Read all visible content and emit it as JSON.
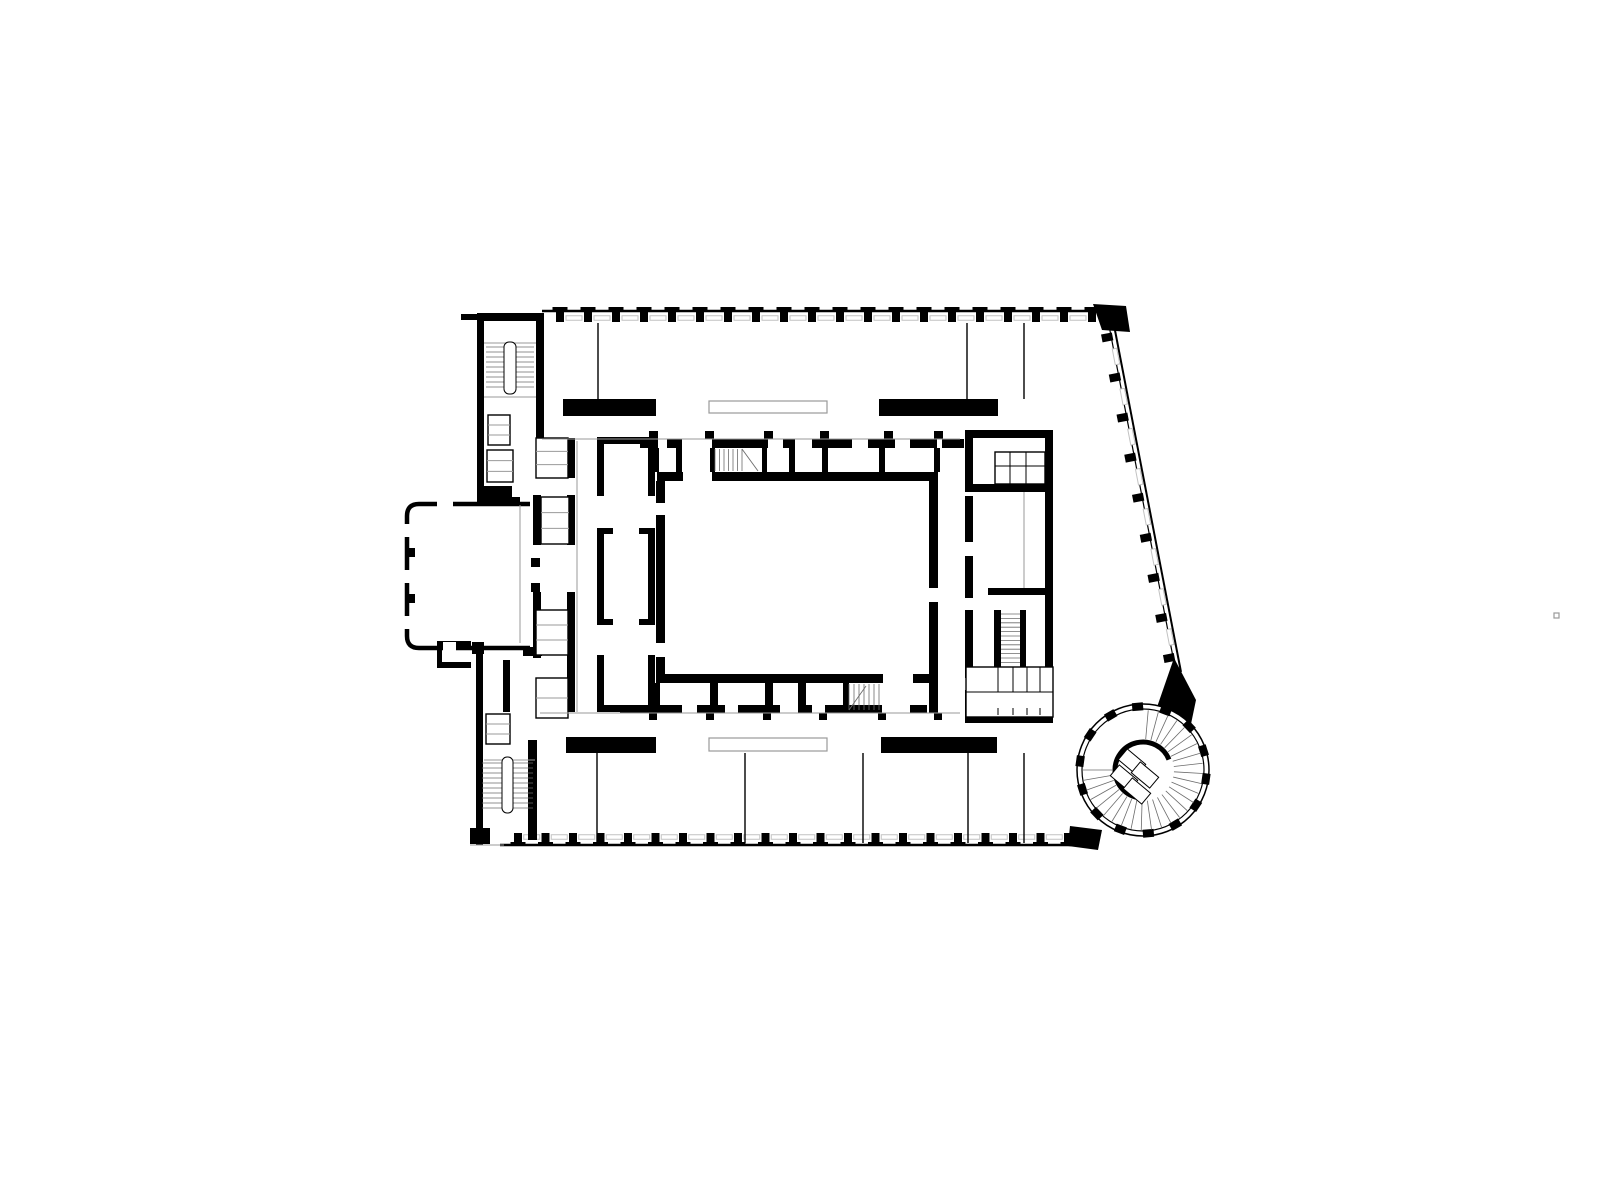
{
  "colors": {
    "bg": "#ffffff",
    "ink": "#000000",
    "gray": "#9a9a9a",
    "light": "#c2c2c2",
    "tread": "#6b6b6b"
  },
  "plan": {
    "facade_runs": [
      {
        "name": "facade-north",
        "x1": 542,
        "y1": 311,
        "x2": 1110,
        "y2": 311,
        "count": 20,
        "capOff": -2,
        "stemOff": 5.5,
        "dash": 7,
        "lw": 2.6
      },
      {
        "name": "facade-south",
        "x1": 500,
        "y1": 845,
        "x2": 1086,
        "y2": 845,
        "count": 21,
        "flip": true,
        "capOff": 1,
        "stemOff": 6.5,
        "dash": 8,
        "lw": 2.6
      },
      {
        "name": "facade-diagonal",
        "x1": 1113,
        "y1": 320,
        "x2": 1181,
        "y2": 672,
        "count": 9,
        "margin": 16,
        "nocap": true,
        "stemOff": 9,
        "dash": 4,
        "inner": 5,
        "lw": 2
      }
    ],
    "polys": {
      "corner-block-northeast": [
        [
          [
            1093,
            304
          ],
          [
            1126,
            306
          ],
          [
            1130,
            332
          ],
          [
            1102,
            330
          ]
        ]
      ],
      "tower-connector-northeast": [
        [
          [
            1174,
            658
          ],
          [
            1196,
            700
          ],
          [
            1186,
            748
          ],
          [
            1156,
            710
          ]
        ]
      ],
      "tower-connector-southwest": [
        [
          [
            1070,
            826
          ],
          [
            1102,
            830
          ],
          [
            1098,
            850
          ],
          [
            1068,
            846
          ]
        ]
      ]
    },
    "black": {
      "stair-block-northwest": [
        [
          477,
          313,
          66,
          8
        ],
        [
          477,
          313,
          7,
          192
        ],
        [
          536,
          313,
          8,
          102
        ],
        [
          461,
          314,
          16,
          6
        ],
        [
          536,
          415,
          8,
          55
        ],
        [
          479,
          497,
          41,
          9
        ]
      ],
      "portico-junction-walls": [
        [
          533,
          495,
          8,
          50
        ],
        [
          533,
          592,
          8,
          66
        ],
        [
          531,
          558,
          9,
          9
        ],
        [
          531,
          583,
          9,
          9
        ],
        [
          523,
          647,
          19,
          9
        ],
        [
          481,
          486,
          31,
          14
        ],
        [
          437,
          641,
          34,
          8
        ],
        [
          437,
          662,
          34,
          6
        ],
        [
          437,
          641,
          5,
          27
        ],
        [
          472,
          642,
          12,
          12
        ]
      ],
      "lift-strip-east-wall": [
        [
          567,
          438,
          8,
          40
        ],
        [
          567,
          495,
          8,
          50
        ],
        [
          567,
          592,
          8,
          120
        ]
      ],
      "west-gallery-rooms": [
        [
          597,
          437,
          58,
          7
        ],
        [
          597,
          437,
          7,
          59
        ],
        [
          648,
          437,
          7,
          59
        ],
        [
          597,
          528,
          7,
          97
        ],
        [
          648,
          528,
          7,
          97
        ],
        [
          597,
          528,
          16,
          6
        ],
        [
          639,
          528,
          16,
          6
        ],
        [
          597,
          619,
          16,
          6
        ],
        [
          639,
          619,
          16,
          6
        ],
        [
          597,
          655,
          7,
          57
        ],
        [
          648,
          655,
          7,
          57
        ],
        [
          597,
          705,
          58,
          7
        ]
      ],
      "hall-walls": [
        [
          657,
          472,
          26,
          9
        ],
        [
          712,
          472,
          226,
          9
        ],
        [
          656,
          481,
          9,
          22
        ],
        [
          656,
          515,
          9,
          128
        ],
        [
          656,
          657,
          9,
          26
        ],
        [
          656,
          674,
          227,
          9
        ],
        [
          913,
          674,
          25,
          9
        ],
        [
          929,
          481,
          9,
          107
        ],
        [
          929,
          602,
          9,
          81
        ],
        [
          929,
          683,
          9,
          30
        ]
      ],
      "north-room-row": [
        [
          640,
          439,
          18,
          9
        ],
        [
          667,
          439,
          15,
          9
        ],
        [
          712,
          439,
          56,
          9
        ],
        [
          783,
          439,
          12,
          9
        ],
        [
          812,
          439,
          40,
          9
        ],
        [
          868,
          439,
          27,
          9
        ],
        [
          910,
          439,
          27,
          9
        ],
        [
          942,
          439,
          22,
          9
        ],
        [
          649,
          431,
          9,
          8
        ],
        [
          705,
          431,
          9,
          8
        ],
        [
          764,
          431,
          9,
          8
        ],
        [
          820,
          431,
          9,
          8
        ],
        [
          884,
          431,
          9,
          8
        ],
        [
          934,
          431,
          9,
          8
        ],
        [
          652,
          448,
          7,
          24
        ],
        [
          676,
          448,
          6,
          24
        ],
        [
          710,
          448,
          5,
          24
        ],
        [
          762,
          448,
          5,
          24
        ],
        [
          789,
          448,
          6,
          24
        ],
        [
          822,
          448,
          6,
          24
        ],
        [
          879,
          448,
          6,
          24
        ],
        [
          934,
          448,
          6,
          24
        ]
      ],
      "south-room-row": [
        [
          652,
          683,
          8,
          24
        ],
        [
          710,
          683,
          8,
          24
        ],
        [
          765,
          683,
          8,
          24
        ],
        [
          798,
          683,
          8,
          24
        ],
        [
          843,
          683,
          6,
          28
        ],
        [
          620,
          705,
          62,
          8
        ],
        [
          697,
          705,
          28,
          8
        ],
        [
          738,
          705,
          42,
          8
        ],
        [
          798,
          705,
          14,
          8
        ],
        [
          825,
          705,
          57,
          8
        ],
        [
          910,
          705,
          17,
          8
        ],
        [
          649,
          713,
          8,
          7
        ],
        [
          706,
          713,
          8,
          7
        ],
        [
          763,
          713,
          8,
          7
        ],
        [
          819,
          713,
          8,
          7
        ],
        [
          878,
          713,
          8,
          7
        ],
        [
          934,
          713,
          8,
          7
        ]
      ],
      "gallery-bars": [
        [
          563,
          399,
          93,
          17
        ],
        [
          879,
          399,
          119,
          17
        ],
        [
          566,
          737,
          90,
          16
        ],
        [
          881,
          737,
          116,
          16
        ]
      ],
      "east-wing": [
        [
          965,
          430,
          88,
          8
        ],
        [
          1045,
          430,
          8,
          292
        ],
        [
          965,
          430,
          8,
          58
        ],
        [
          965,
          496,
          8,
          46
        ],
        [
          965,
          556,
          8,
          42
        ],
        [
          965,
          610,
          8,
          68
        ],
        [
          965,
          690,
          8,
          32
        ],
        [
          965,
          484,
          88,
          8
        ],
        [
          988,
          588,
          65,
          7
        ],
        [
          994,
          610,
          7,
          57
        ],
        [
          1020,
          610,
          6,
          57
        ],
        [
          965,
          715,
          88,
          8
        ]
      ],
      "stair-block-southwest": [
        [
          476,
          652,
          7,
          193
        ],
        [
          503,
          660,
          7,
          52
        ],
        [
          528,
          740,
          9,
          100
        ],
        [
          477,
          740,
          6,
          103
        ],
        [
          470,
          828,
          20,
          16
        ]
      ]
    },
    "portico": {
      "path": "M 530 504 L 419 504 Q 407 504 407 516 L 407 636 Q 407 648 419 648 L 530 648",
      "stroke_w": 4.5,
      "patches": [
        [
          402,
          524,
          10,
          13
        ],
        [
          402,
          570,
          10,
          13
        ],
        [
          402,
          616,
          10,
          13
        ],
        [
          437,
          500,
          16,
          8
        ],
        [
          443,
          642,
          13,
          9
        ]
      ],
      "bumps": [
        [
          407,
          548,
          8,
          9
        ],
        [
          407,
          594,
          8,
          9
        ]
      ]
    },
    "boxes": {
      "lift-cars-and-closets": [
        [
          488,
          415,
          22,
          30,
          2
        ],
        [
          487,
          450,
          26,
          32,
          2
        ],
        [
          486,
          714,
          24,
          30,
          2
        ],
        [
          536,
          438,
          32,
          40,
          2
        ],
        [
          541,
          497,
          28,
          47,
          2
        ],
        [
          536,
          610,
          32,
          45,
          2
        ],
        [
          536,
          678,
          32,
          40,
          1
        ],
        [
          995,
          452,
          50,
          32,
          0
        ],
        [
          966,
          667,
          87,
          50,
          0
        ]
      ]
    },
    "gray_boxes": {
      "glazed-gallery-screens": [
        [
          709,
          401,
          118,
          12
        ],
        [
          709,
          738,
          118,
          13
        ]
      ],
      "stray-mark": [
        [
          1554,
          613,
          5,
          5
        ]
      ]
    },
    "lines": {
      "room-partitions": {
        "c": "k",
        "w": 1.4,
        "segs": [
          [
            598,
            323,
            598,
            399
          ],
          [
            967,
            323,
            967,
            399
          ],
          [
            1024,
            323,
            1024,
            399
          ],
          [
            597,
            753,
            597,
            843
          ],
          [
            745,
            753,
            745,
            843
          ],
          [
            863,
            753,
            863,
            843
          ],
          [
            968,
            753,
            968,
            843
          ],
          [
            1024,
            753,
            1024,
            843
          ]
        ]
      },
      "floor-lines": {
        "c": "g",
        "w": 1,
        "segs": [
          [
            542,
            439,
            960,
            439
          ],
          [
            540,
            713,
            960,
            713
          ],
          [
            577,
            441,
            577,
            712
          ],
          [
            1024,
            492,
            1024,
            588
          ],
          [
            484,
            343,
            536,
            343
          ],
          [
            484,
            397,
            536,
            397
          ],
          [
            484,
            760,
            535,
            760
          ],
          [
            520,
            505,
            520,
            643
          ],
          [
            470,
            845,
            504,
            845
          ]
        ]
      },
      "closet-grids": {
        "c": "k",
        "w": 1,
        "segs": [
          [
            1010,
            452,
            1010,
            484
          ],
          [
            1026,
            452,
            1026,
            484
          ],
          [
            995,
            466,
            1045,
            466
          ],
          [
            998,
            667,
            998,
            692
          ],
          [
            1013,
            667,
            1013,
            692
          ],
          [
            1027,
            667,
            1027,
            692
          ],
          [
            1040,
            667,
            1040,
            692
          ],
          [
            966,
            692,
            1053,
            692
          ],
          [
            998,
            708,
            998,
            715
          ],
          [
            1013,
            708,
            1013,
            715
          ],
          [
            1027,
            708,
            1027,
            715
          ],
          [
            1040,
            708,
            1040,
            715
          ]
        ]
      }
    },
    "stairs": [
      {
        "name": "stair-northwest",
        "x": 486,
        "y": 347,
        "w": 48,
        "h": 44,
        "step": 5,
        "dir": "h",
        "rail": [
          504,
          342,
          12,
          52
        ]
      },
      {
        "name": "stair-southwest",
        "x": 482,
        "y": 763,
        "w": 51,
        "h": 47,
        "step": 5,
        "dir": "h",
        "rail": [
          502,
          757,
          11,
          56
        ]
      },
      {
        "name": "stair-hall-north",
        "x": 715,
        "y": 449,
        "w": 27,
        "h": 22,
        "step": 4.5,
        "dir": "v",
        "diag": [
          742,
          449,
          758,
          471
        ]
      },
      {
        "name": "stair-hall-south",
        "x": 849,
        "y": 684,
        "w": 30,
        "h": 26,
        "step": 5,
        "dir": "v",
        "diag": [
          849,
          710,
          866,
          686
        ]
      },
      {
        "name": "stair-east-wing",
        "x": 1001,
        "y": 614,
        "w": 19,
        "h": 50,
        "step": 4.4,
        "dir": "h"
      }
    ],
    "tower": {
      "cx": 1143,
      "cy": 770,
      "r_outer": 66,
      "r_inner_ring": 61,
      "ticks": {
        "count": 14,
        "w": 11,
        "h": 8,
        "r": 63.5,
        "a_offset": 8
      },
      "treads": {
        "a0": -85,
        "a1": 180,
        "n": 28,
        "r0": 31,
        "r1": 60
      },
      "core_arc": {
        "r": 28,
        "a0": 95,
        "a1": 338,
        "w": 5
      },
      "steps": [
        [
          1132,
          762,
          24,
          14,
          40
        ],
        [
          1145,
          775,
          24,
          14,
          40
        ],
        [
          1124,
          778,
          24,
          14,
          40
        ],
        [
          1137,
          791,
          24,
          14,
          40
        ]
      ]
    }
  }
}
